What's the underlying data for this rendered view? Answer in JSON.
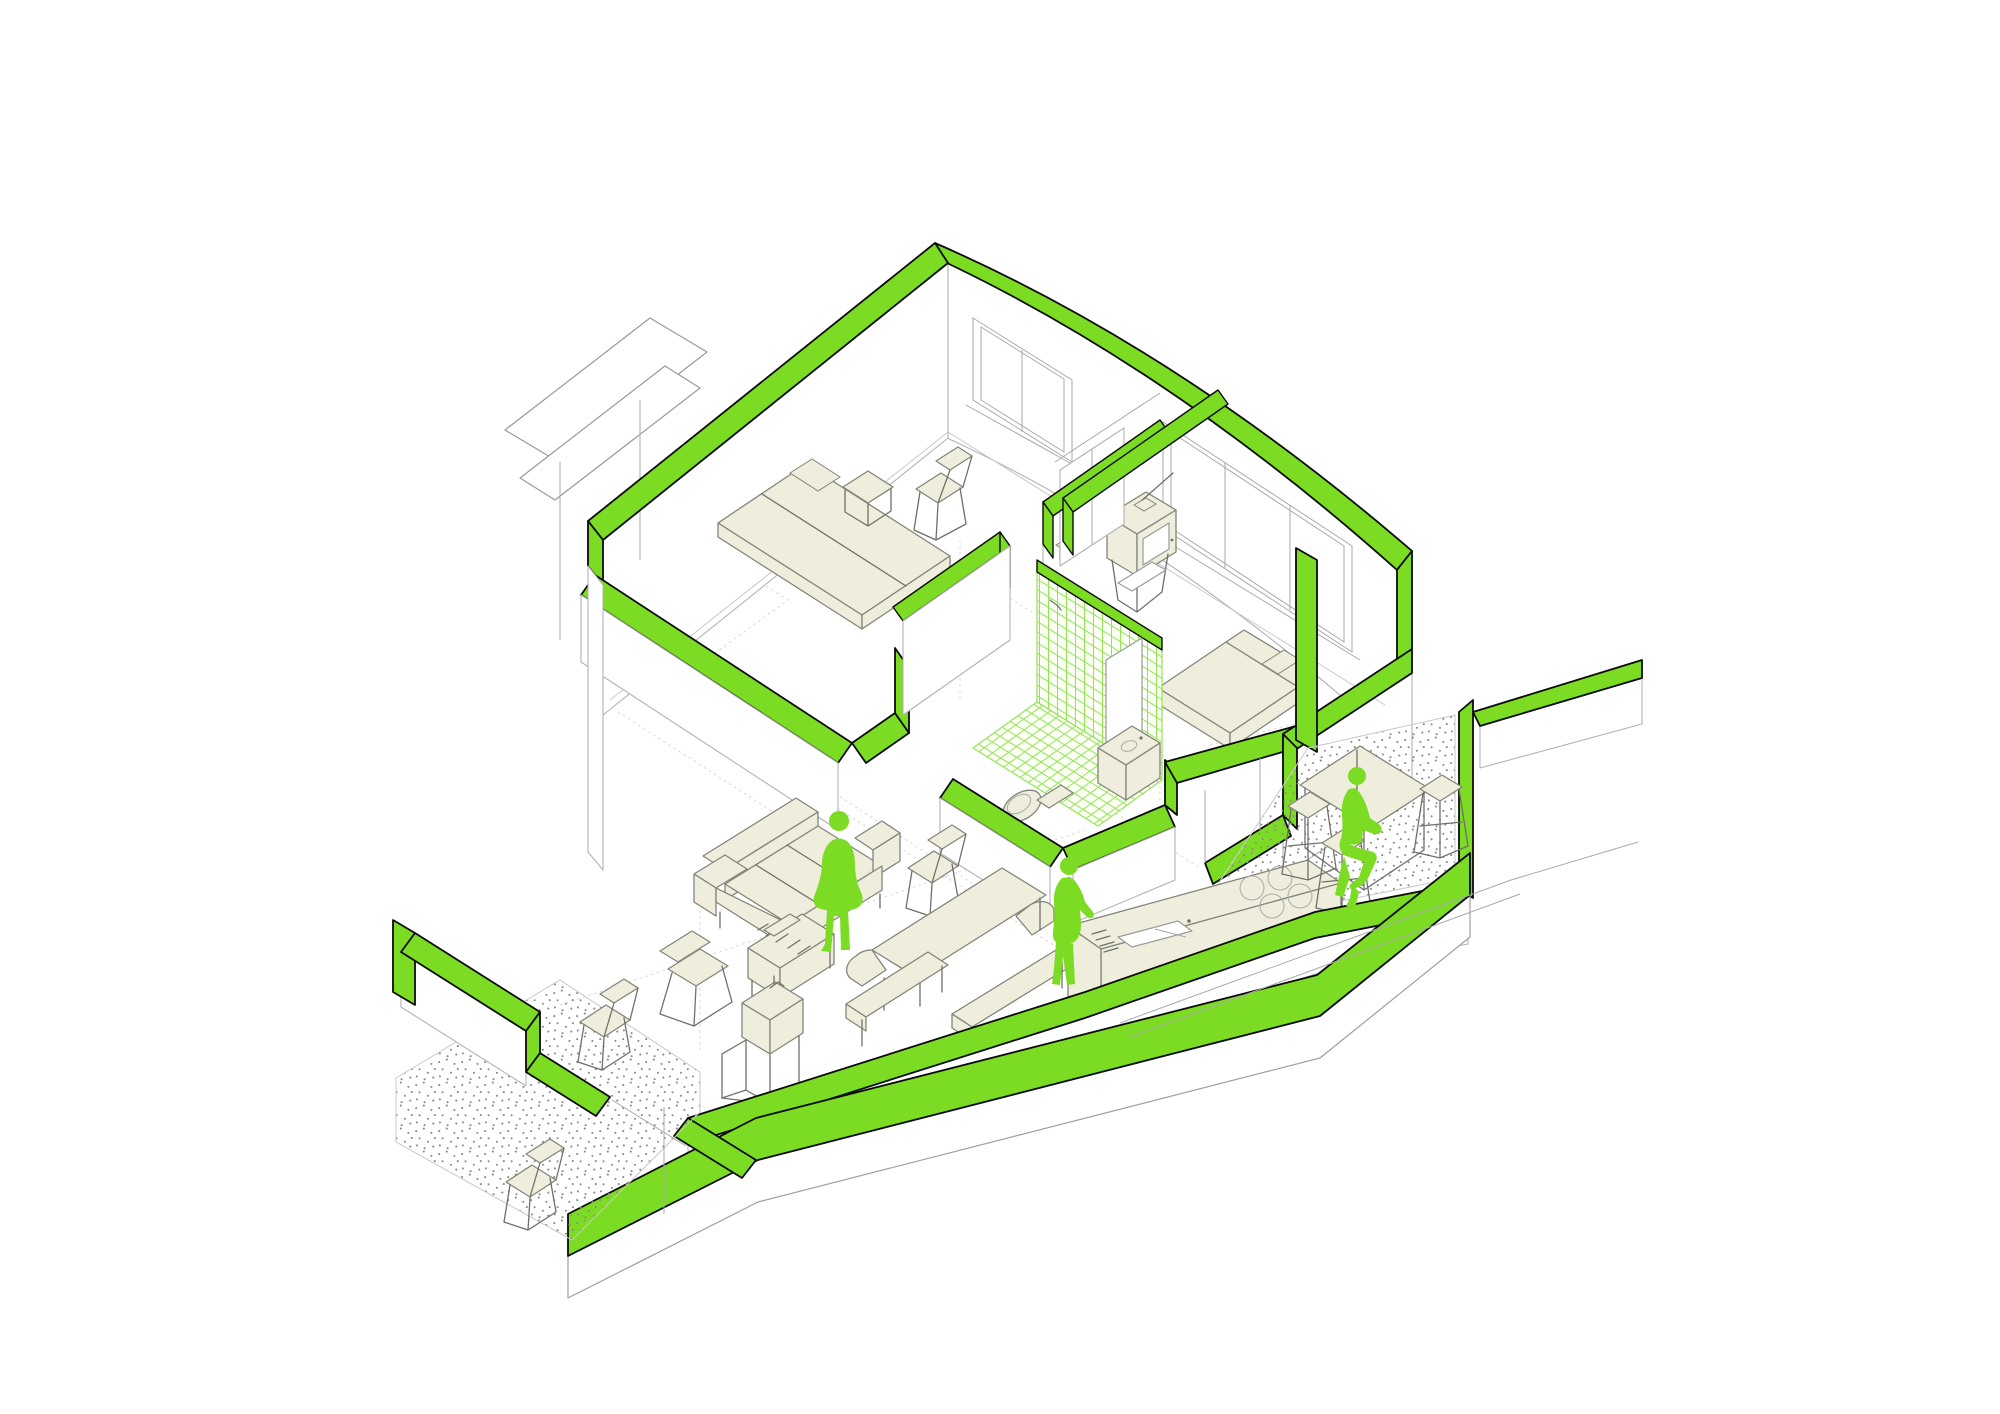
{
  "title": "Axonometric cutaway diagram of a small apartment",
  "figure": {
    "type": "axonometric-cutaway",
    "style": "section-cut walls highlighted in green, line-drawn interior",
    "colors": {
      "green": "#7cdc23",
      "green-mesh": "#93e455",
      "cream": "#efeedc",
      "ink": "#0b0b0b",
      "furn-line": "#83847a",
      "wall-line": "#b3b3b3",
      "floor-line": "#c8c8c8",
      "guide": "#d6d6d6",
      "dot": "#8c8c8c",
      "bg": "#ffffff"
    },
    "rooms": [
      {
        "name": "bedroom-1",
        "furniture": [
          "double-bed",
          "bedside-stool",
          "desk-chairs",
          "wall-shelf",
          "wardrobe"
        ]
      },
      {
        "name": "bedroom-2",
        "furniture": [
          "daybed",
          "tv-on-stand",
          "wall-lamp"
        ]
      },
      {
        "name": "bathroom",
        "furniture": [
          "washbasin",
          "mirror-panel"
        ],
        "finish": "green-mesh-tiles"
      },
      {
        "name": "wc",
        "furniture": [
          "toilet"
        ]
      },
      {
        "name": "living-room",
        "furniture": [
          "three-seat-sofa",
          "armchair",
          "wire-chair",
          "sideboard-with-books",
          "lamp-cube",
          "picnic-table",
          "bench",
          "bench"
        ]
      },
      {
        "name": "kitchen",
        "furniture": [
          "island-counter",
          "sink",
          "cooktop",
          "high-table",
          "stool",
          "stool",
          "stool"
        ]
      },
      {
        "name": "terrace-left",
        "furniture": [
          "wire-chair",
          "wire-chair"
        ],
        "finish": "stippled-paving"
      },
      {
        "name": "terrace-right",
        "finish": "stippled-paving"
      }
    ],
    "people": [
      {
        "name": "person-standing-living-room"
      },
      {
        "name": "person-standing-kitchen"
      },
      {
        "name": "person-sitting-high-table"
      }
    ]
  }
}
